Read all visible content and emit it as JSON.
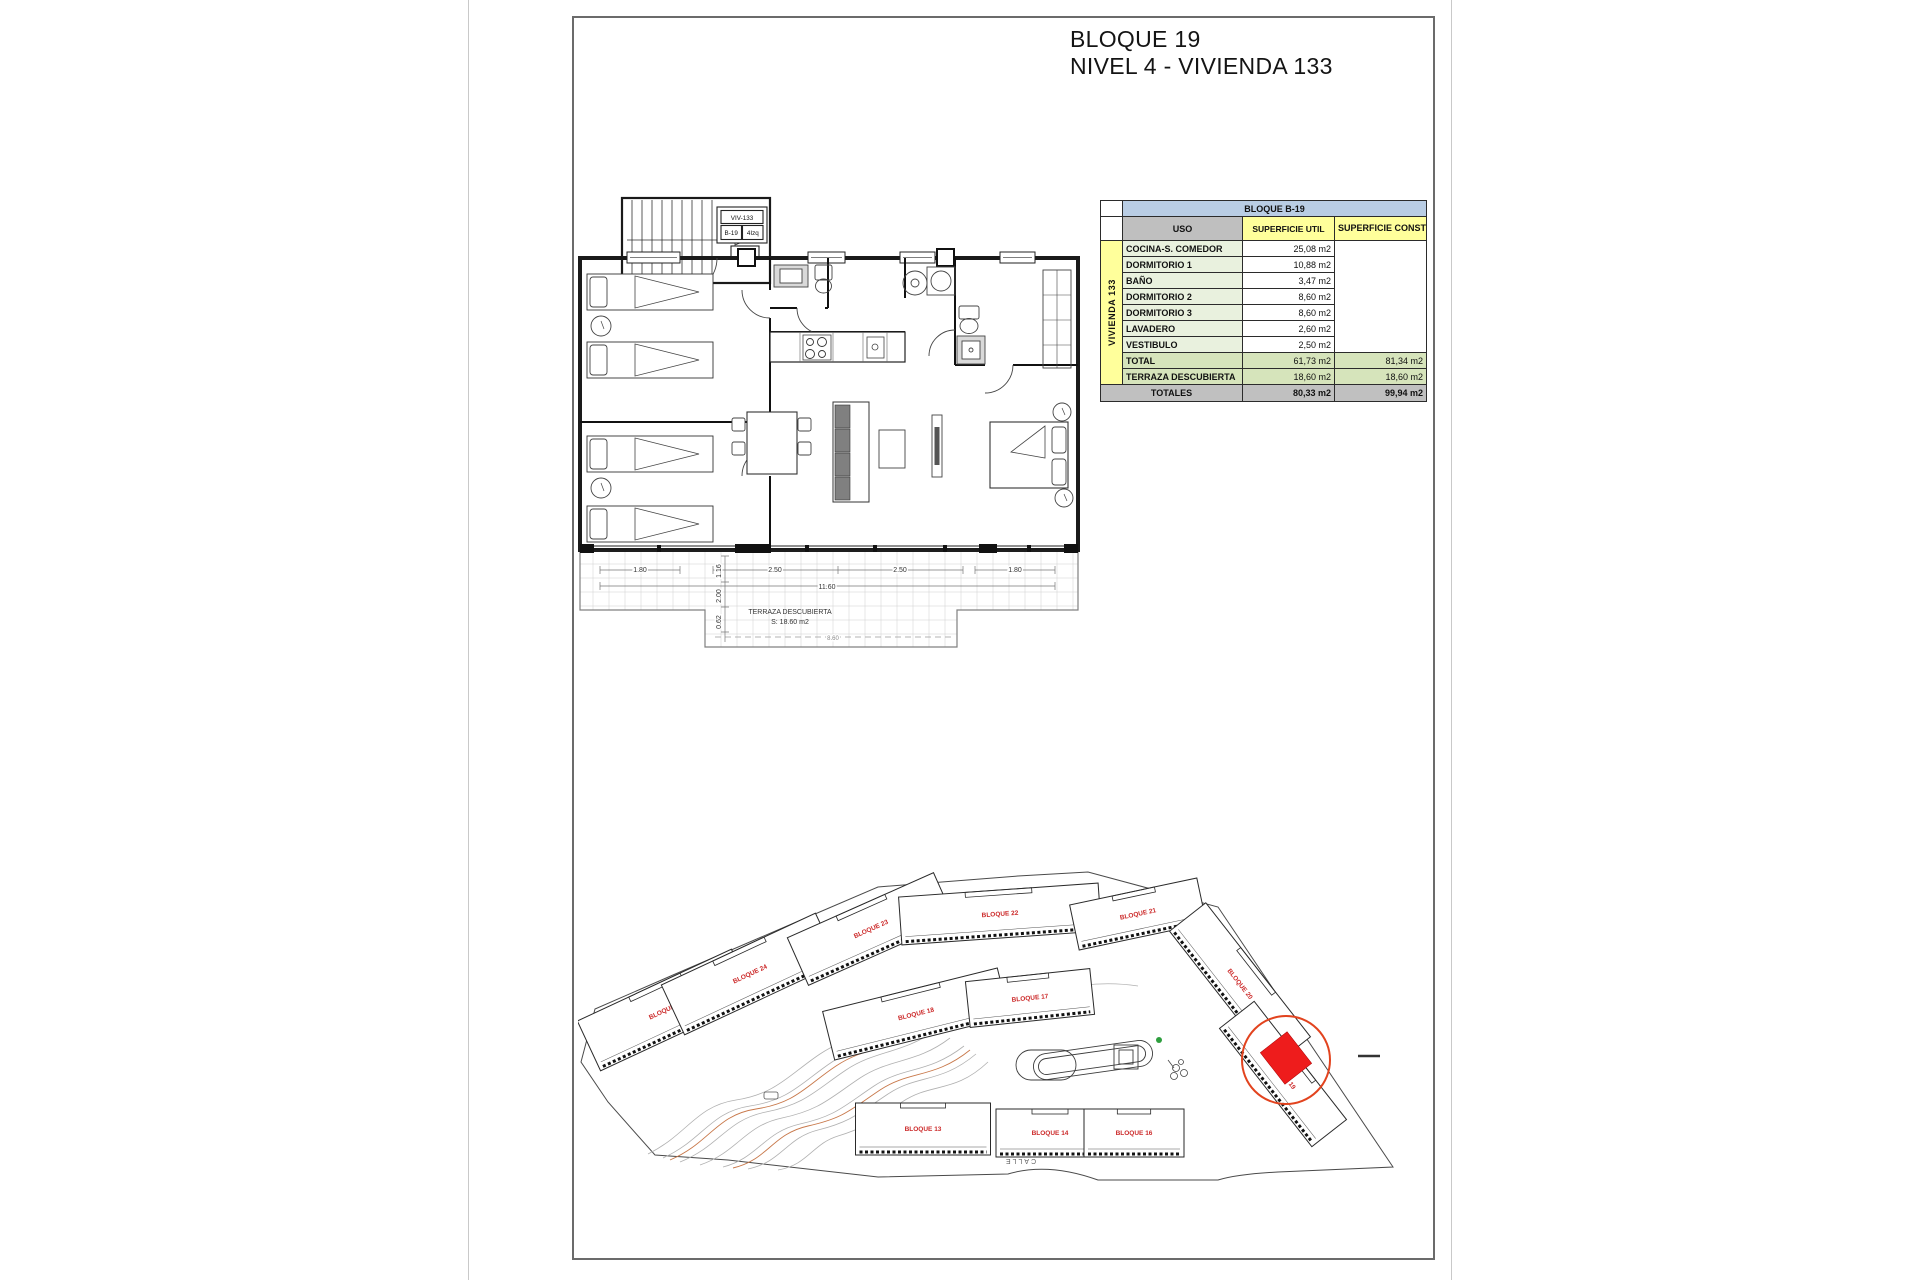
{
  "page": {
    "title_line1": "BLOQUE 19",
    "title_line2": "NIVEL 4 - VIVIENDA 133"
  },
  "floor_plan": {
    "unit_tag": {
      "id": "VIV-133",
      "block": "B-19",
      "position": "4Izq",
      "level_value": "50.83"
    },
    "terrace_label": "TERRAZA DESCUBIERTA",
    "terrace_area": "S: 18.60 m2",
    "dims_horizontal": [
      {
        "label": "1.80",
        "x": 65,
        "y": 382
      },
      {
        "label": "2.50",
        "x": 200,
        "y": 382
      },
      {
        "label": "2.50",
        "x": 325,
        "y": 382
      },
      {
        "label": "1.80",
        "x": 440,
        "y": 382
      },
      {
        "label": "11.60",
        "x": 252,
        "y": 399
      }
    ],
    "dims_vertical": [
      {
        "label": "1.16",
        "x": 146,
        "y": 381
      },
      {
        "label": "2.00",
        "x": 146,
        "y": 406
      },
      {
        "label": "0.62",
        "x": 146,
        "y": 432
      }
    ],
    "dim_extra": {
      "label": "8.60",
      "x": 258,
      "y": 450
    }
  },
  "area_table": {
    "title": "BLOQUE B-19",
    "group_label": "VIVIENDA 133",
    "headers": {
      "uso": "USO",
      "util": "SUPERFICIE UTIL",
      "construida": "SUPERFICIE CONSTRUIDA"
    },
    "rows": [
      {
        "uso": "COCINA-S. COMEDOR",
        "util": "25,08 m2"
      },
      {
        "uso": "DORMITORIO 1",
        "util": "10,88 m2"
      },
      {
        "uso": "BAÑO",
        "util": "3,47 m2"
      },
      {
        "uso": "DORMITORIO 2",
        "util": "8,60 m2"
      },
      {
        "uso": "DORMITORIO 3",
        "util": "8,60 m2"
      },
      {
        "uso": "LAVADERO",
        "util": "2,60 m2"
      },
      {
        "uso": "VESTIBULO",
        "util": "2,50 m2"
      }
    ],
    "total_row": {
      "uso": "TOTAL",
      "util": "61,73 m2",
      "construida": "81,34 m2"
    },
    "terraza_row": {
      "uso": "TERRAZA DESCUBIERTA",
      "util": "18,60 m2",
      "construida": "18,60 m2"
    },
    "totales_row": {
      "label": "TOTALES",
      "util": "80,33 m2",
      "construida": "99,94 m2"
    }
  },
  "site_plan": {
    "street_label": "CALLE",
    "highlighted_block": "BLOQUE 19",
    "blocks": [
      {
        "label": "BLOQUE 20",
        "x": 88,
        "y": 148,
        "rot": -25,
        "w": 170,
        "h": 55
      },
      {
        "label": "BLOQUE 24",
        "x": 172,
        "y": 112,
        "rot": -25,
        "w": 170,
        "h": 55
      },
      {
        "label": "BLOQUE 23",
        "x": 293,
        "y": 67,
        "rot": -24,
        "w": 160,
        "h": 52
      },
      {
        "label": "BLOQUE 22",
        "x": 422,
        "y": 52,
        "rot": -4,
        "w": 200,
        "h": 48
      },
      {
        "label": "BLOQUE 21",
        "x": 560,
        "y": 52,
        "rot": -12,
        "w": 130,
        "h": 46
      },
      {
        "label": "BLOQUE 18",
        "x": 338,
        "y": 152,
        "rot": -14,
        "w": 180,
        "h": 50
      },
      {
        "label": "BLOQUE 17",
        "x": 452,
        "y": 136,
        "rot": -6,
        "w": 125,
        "h": 46
      },
      {
        "label": "BLOQUE 20",
        "x": 662,
        "y": 122,
        "rot": 52,
        "w": 170,
        "h": 46
      },
      {
        "label": "BLOQUE 19",
        "x": 705,
        "y": 212,
        "rot": 52,
        "w": 150,
        "h": 44
      },
      {
        "label": "BLOQUE 13",
        "x": 345,
        "y": 267,
        "rot": 0,
        "w": 135,
        "h": 52
      },
      {
        "label": "BLOQUE 14",
        "x": 472,
        "y": 271,
        "rot": 0,
        "w": 108,
        "h": 48
      },
      {
        "label": "BLOQUE 16",
        "x": 556,
        "y": 271,
        "rot": 0,
        "w": 100,
        "h": 48
      }
    ]
  },
  "colors": {
    "table_blue": "#b9cde4",
    "table_gray": "#bfbfbf",
    "table_yellow": "#ffff9b",
    "table_green_light": "#e9f1de",
    "table_green": "#d6e4bb",
    "block_label_red": "#cc2a2a",
    "highlight_red": "#ee1c1c",
    "highlight_circle": "#e2431e",
    "contour_gray": "#b0b0b0",
    "contour_orange": "#c8784a"
  }
}
